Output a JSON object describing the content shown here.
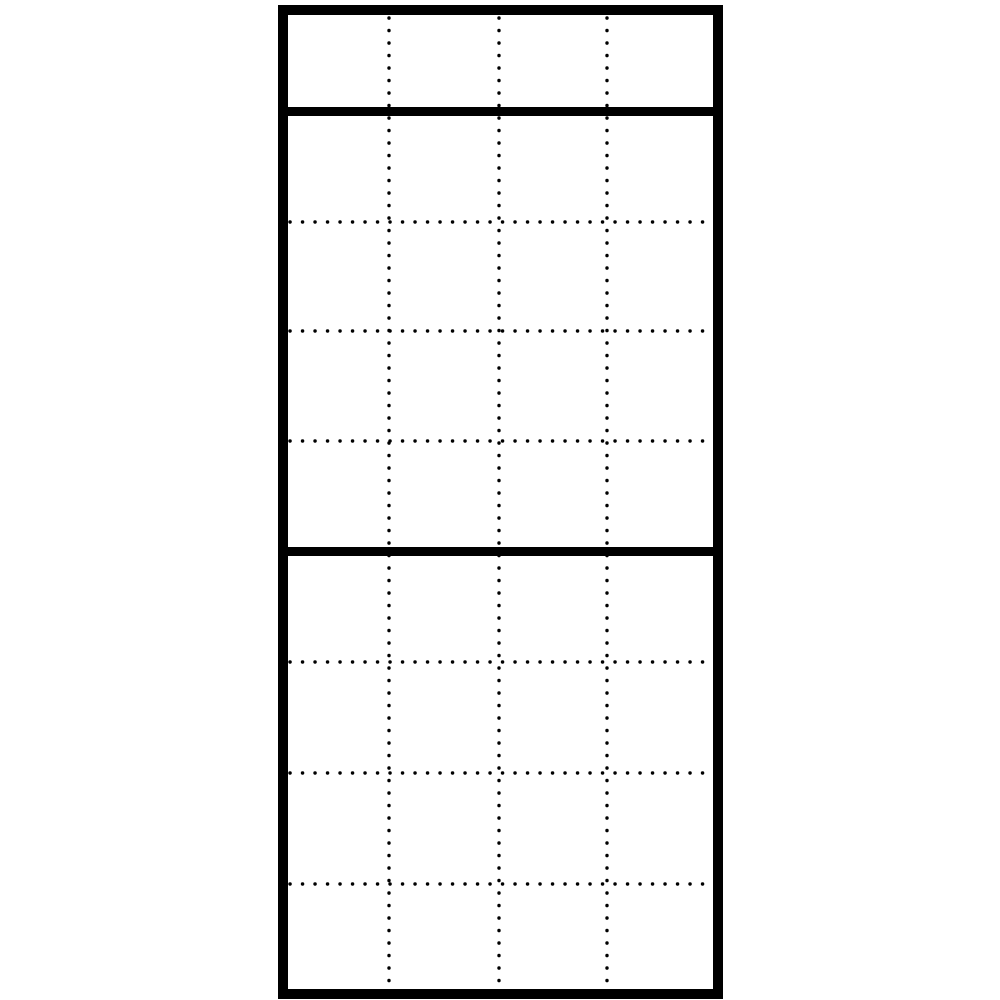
{
  "canvas": {
    "width": 1000,
    "height": 1000,
    "background_color": "#ffffff"
  },
  "diagram": {
    "description": "module-grid-panel-drawing",
    "stroke_color": "#000000",
    "frame": {
      "x": 278,
      "y": 5,
      "width": 445,
      "height": 994,
      "border_width": 10
    },
    "solid_dividers": {
      "y_positions": [
        111.5,
        551.5
      ],
      "thickness": 9
    },
    "dotted_vertical_lines": {
      "x_positions": [
        389,
        499,
        607
      ]
    },
    "dotted_horizontal_lines": {
      "y_positions": [
        222,
        331,
        441,
        662,
        773,
        884
      ]
    },
    "dot_style": {
      "dot_diameter": 3.4,
      "dot_gap": 12.4
    }
  }
}
